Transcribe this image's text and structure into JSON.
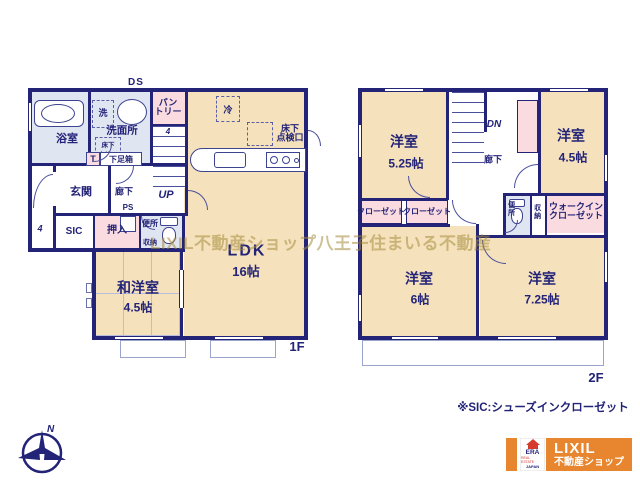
{
  "colors": {
    "wall": "#232377",
    "room_beige": "#f5e2bd",
    "room_blue": "#e0e5f2",
    "room_pink": "#fadce0",
    "logo_orange": "#e8862f",
    "logo_red": "#d6392e",
    "watermark": "#a58c3c"
  },
  "floor1": {
    "floor_label": "1F",
    "duct": "DS",
    "bathroom": "浴室",
    "washer": "洗",
    "washroom": "洗面所",
    "hatch_line1": "床下",
    "hatch_line2": "点検口",
    "pantry_line1": "パン",
    "pantry_line2": "トリー",
    "stair_count": "4",
    "up": "UP",
    "fridge": "冷",
    "ldk_hatch_line1": "床下",
    "ldk_hatch_line2": "点検口",
    "ldk": "LDK",
    "ldk_size": "16帖",
    "entrance": "玄関",
    "porch_step": "4",
    "t_box": "T",
    "shoe_box": "下足箱",
    "hallway": "廊下",
    "ps": "PS",
    "sic": "SIC",
    "closet": "押入",
    "toilet": "便所",
    "storage": "収納",
    "washitsu": "和洋室",
    "washitsu_size": "4.5帖"
  },
  "floor2": {
    "floor_label": "2F",
    "dn": "DN",
    "hallway": "廊下",
    "bedroom_a": "洋室",
    "bedroom_a_size": "5.25帖",
    "bedroom_b": "洋室",
    "bedroom_b_size": "4.5帖",
    "toilet": "便所",
    "storage": "収納",
    "wic_line1": "ウォークイン",
    "wic_line2": "クローゼット",
    "closet_a": "クローゼット",
    "closet_b": "クローゼット",
    "bedroom_c": "洋室",
    "bedroom_c_size": "6帖",
    "bedroom_d": "洋室",
    "bedroom_d_size": "7.25帖"
  },
  "annotations": {
    "watermark": "LIXIL不動産ショップ八王子住まいる不動産",
    "sic_note": "※SIC:シューズインクローゼット",
    "compass_north": "N"
  },
  "logo": {
    "era": "ERA",
    "era_sub": "REAL ESTATE",
    "era_country": "JAPAN",
    "brand": "LIXIL",
    "brand_sub": "不動産ショップ"
  }
}
